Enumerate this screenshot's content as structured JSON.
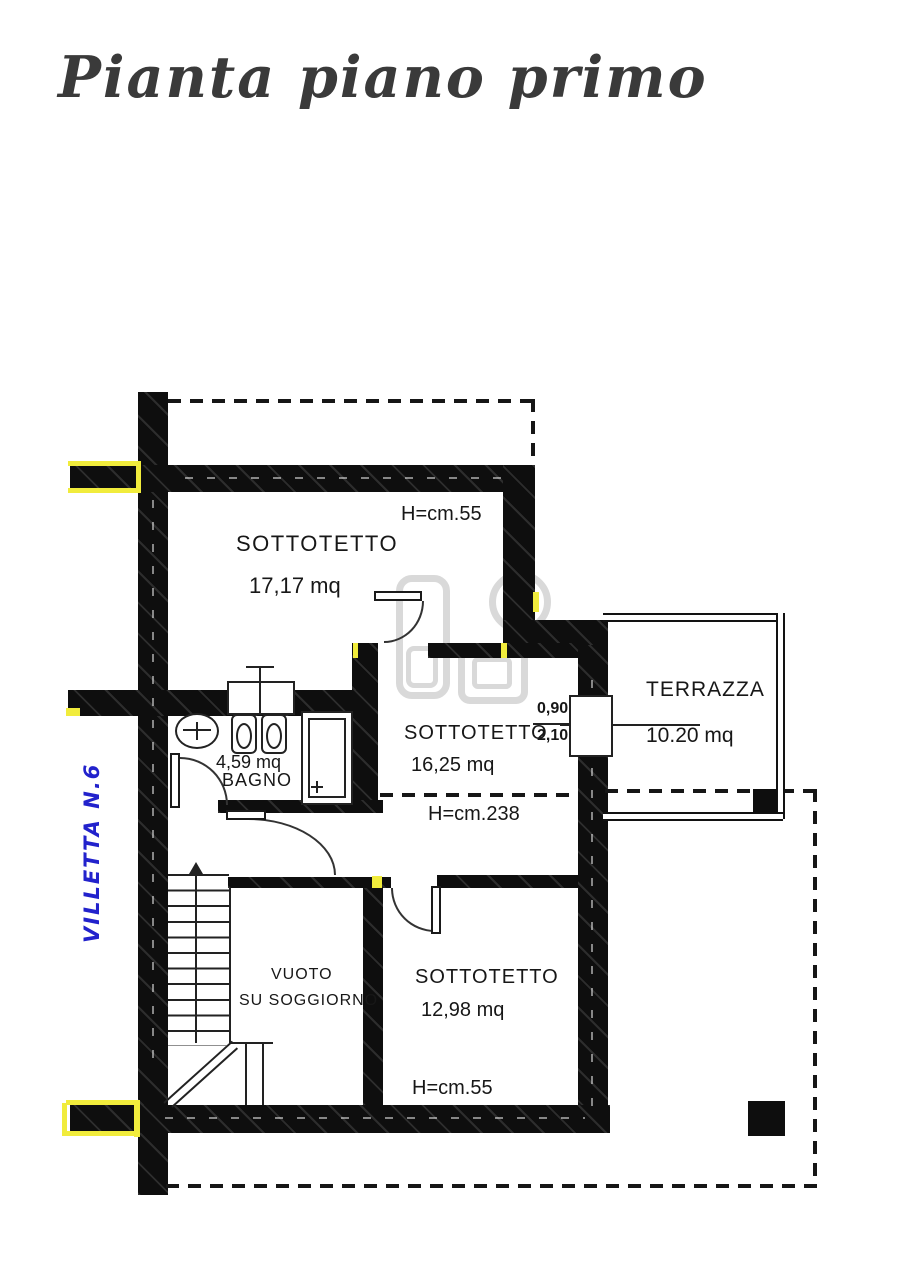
{
  "title": "Pianta piano primo",
  "unit_label": {
    "text": "VILLETTA N.6",
    "color": "#2222cc"
  },
  "rooms": {
    "sottotetto_top": {
      "name": "SOTTOTETTO",
      "area": "17,17  mq",
      "height_note": "H=cm.55"
    },
    "sottotetto_mid": {
      "name": "SOTTOTETTO",
      "area": "16,25  mq",
      "height_note": "H=cm.238"
    },
    "sottotetto_bottom": {
      "name": "SOTTOTETTO",
      "area": "12,98  mq",
      "height_note": "H=cm.55"
    },
    "bagno": {
      "name": "BAGNO",
      "area": "4,59  mq"
    },
    "terrazza": {
      "name": "TERRAZZA",
      "area": "10.20  mq"
    },
    "vuoto": {
      "name_line1": "VUOTO",
      "name_line2": "SU  SOGGIORNO"
    }
  },
  "door_dimension": {
    "width": "0,90",
    "height": "2,10"
  },
  "colors": {
    "wall": "#0e0e0e",
    "highlight_yellow": "#f1ec3c",
    "label_blue": "#2222cc",
    "watermark_gray": "#d9d9d9",
    "text": "#171717"
  }
}
